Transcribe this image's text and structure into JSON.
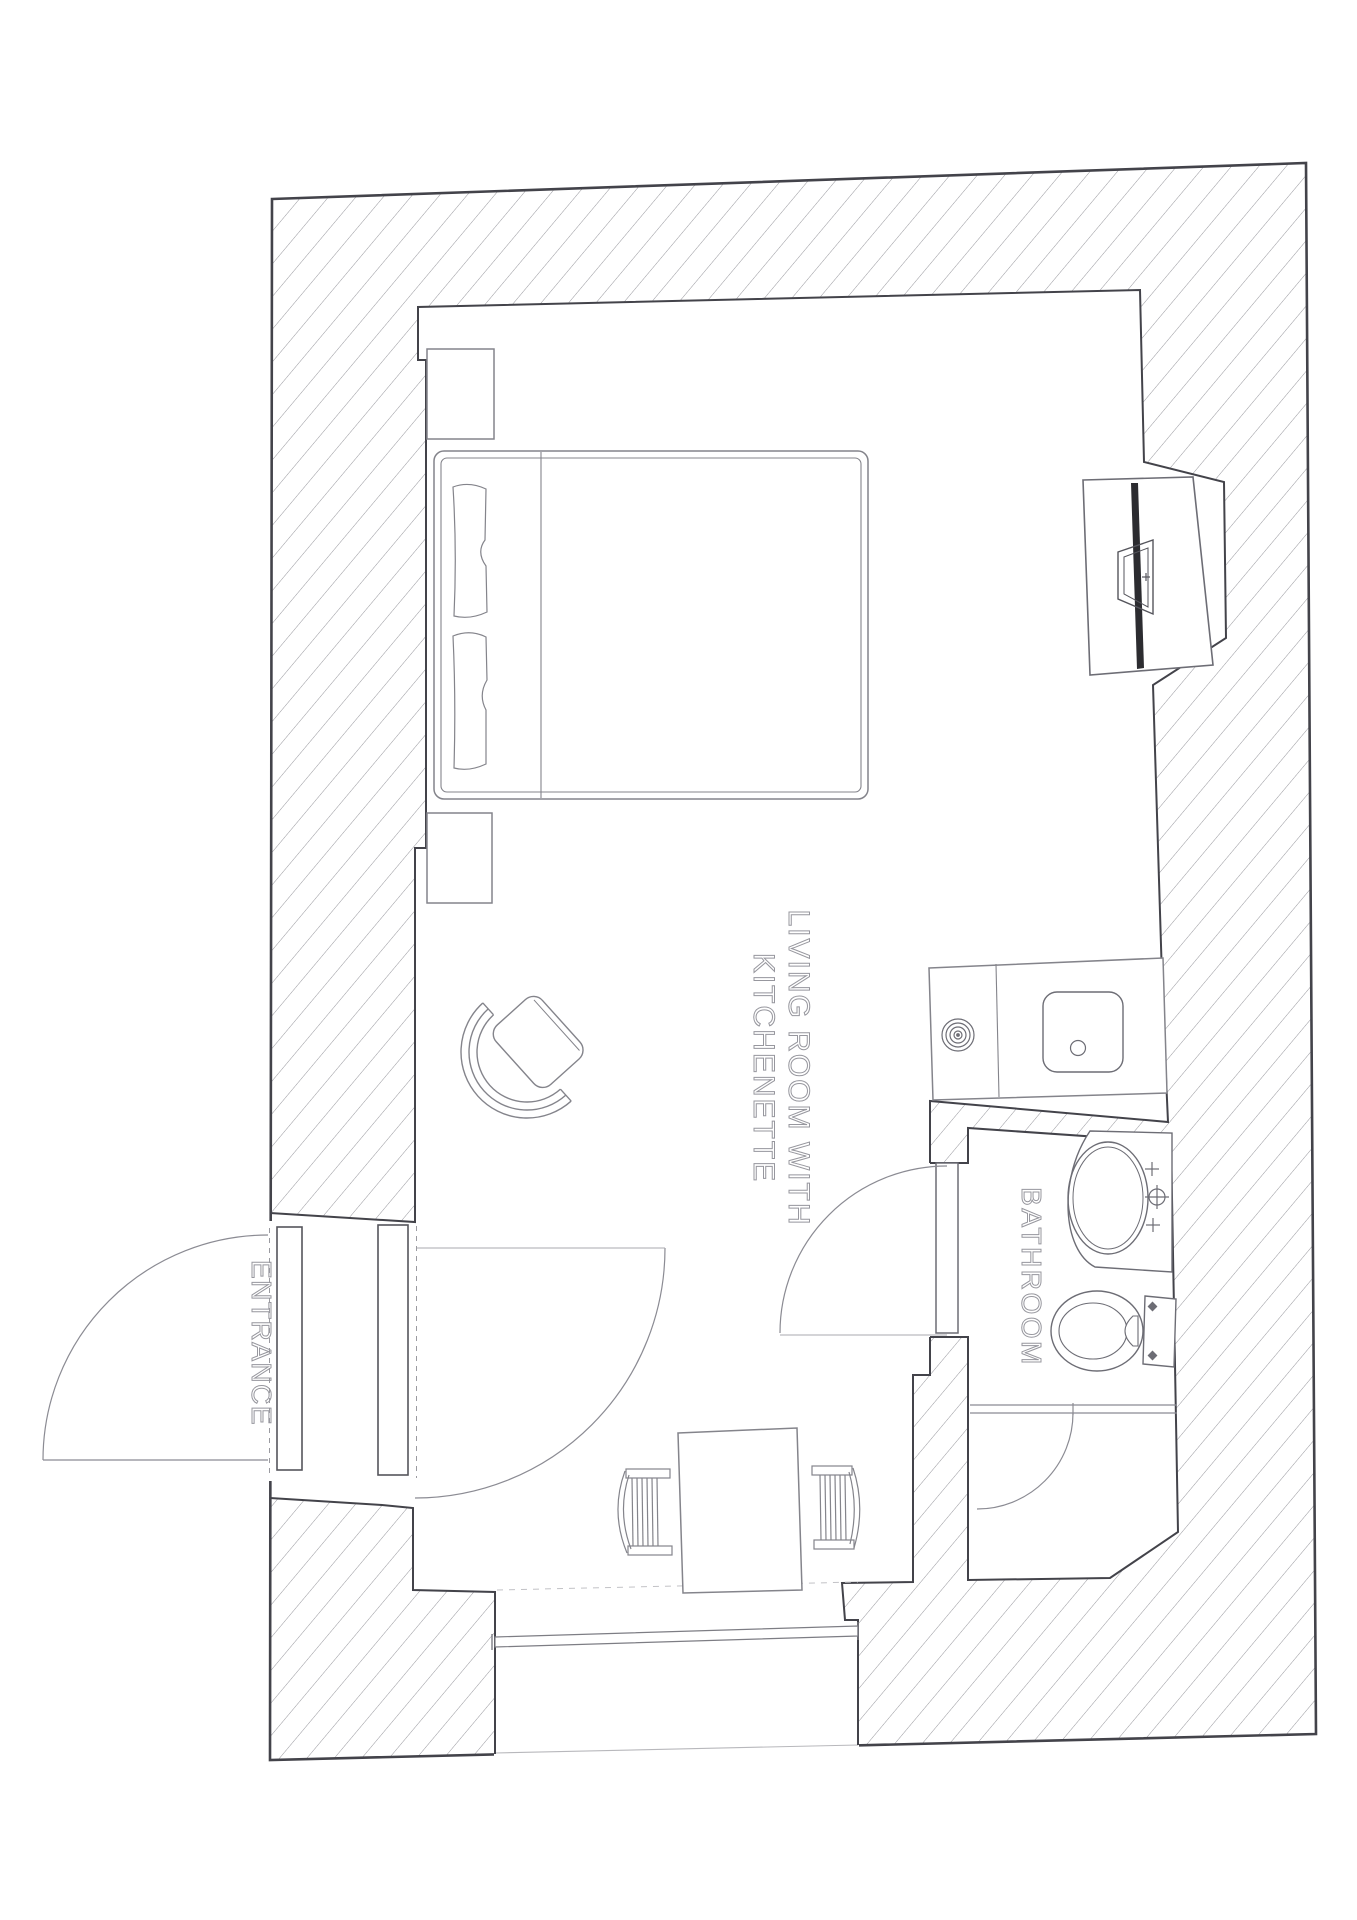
{
  "drawing": {
    "type": "architectural-floor-plan",
    "labels": {
      "living_room_line1": "LIVING ROOM WITH",
      "living_room_line2": "KITCHENETTE",
      "entrance": "ENTRANCE",
      "bathroom": "BATHROOM"
    },
    "rooms": [
      "living room with kitchenette",
      "bathroom",
      "entrance"
    ],
    "furniture": [
      "double-bed",
      "nightstand",
      "nightstand",
      "armchair",
      "desk-tv-unit",
      "kitchен-counter",
      "cooktop-burner",
      "kitchen-sink",
      "washbasin",
      "toilet",
      "shower-door",
      "dining-table",
      "chair",
      "chair",
      "entrance-door",
      "bathroom-door",
      "window"
    ],
    "colors": {
      "background": "#ffffff",
      "wall_line": "#43434a",
      "furniture_line": "#84848b",
      "fixture_line": "#6d6d75",
      "hatch_line": "#97979d",
      "tv_fill": "#2c2c30",
      "label_outline": "#97979e"
    }
  }
}
